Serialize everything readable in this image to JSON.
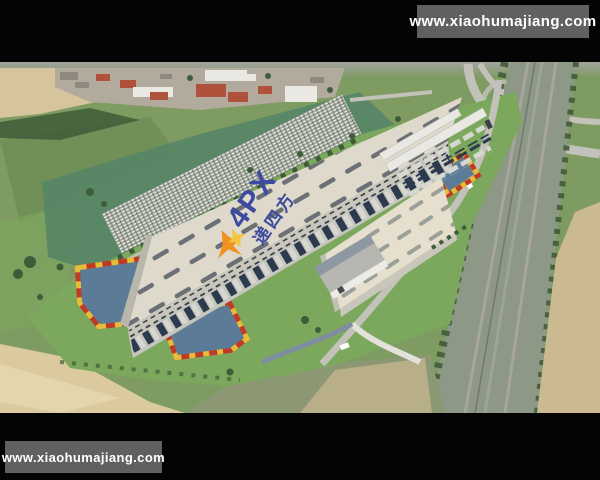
{
  "page": {
    "title": "Aerial rendering of a 4PX logistics park"
  },
  "watermarks": {
    "top": "www.xiaohumajiang.com",
    "bottom": "www.xiaohumajiang.com"
  },
  "roof_logo": {
    "latin": "4PX",
    "chinese": "递四方"
  },
  "colors": {
    "black_bar": "#040404",
    "watermark_bar": "#606060",
    "watermark_text": "#ffffff",
    "haze": "#a3a39f",
    "field": "#7e9b62",
    "field_dark": "#6e8d55",
    "lawn": "#7ca85e",
    "teal_field": "#578566",
    "tan_far": "#d5c49c",
    "tan_left": "#dcca9f",
    "tan_right": "#cbb992",
    "olive": "#8b9873",
    "village_base": "#b2ab9d",
    "red_roof": "#b0523b",
    "white_roof": "#e9e8e2",
    "gray_roof": "#8f8a80",
    "trees": "#3f5c38",
    "yard": "#99a091",
    "roof1": "#ded9cb",
    "roof2": "#e6dfcd",
    "skylight": "#5d646c",
    "skylight2": "#9aa098",
    "wall": "#c9c6bb",
    "apron": "#c6c6bf",
    "dock_door": "#39414b",
    "truck_dark": "#2c3a4d",
    "truck_light": "#d8d8d2",
    "office_roof": "#b7b7b1",
    "office_dark": "#8e98a2",
    "water": "#5c7b97",
    "flower_red": "#c03a28",
    "flower_yellow": "#e5bd3a",
    "road": "#c2c2ba",
    "road_white": "#e3e2da",
    "path_blue": "#7e8da0",
    "rail_band": "#8e9886",
    "track": "#a6a69e",
    "logo_blue": "#3c4ba0",
    "emblem_orange": "#ef9220",
    "emblem_yellow": "#f5c33c"
  }
}
